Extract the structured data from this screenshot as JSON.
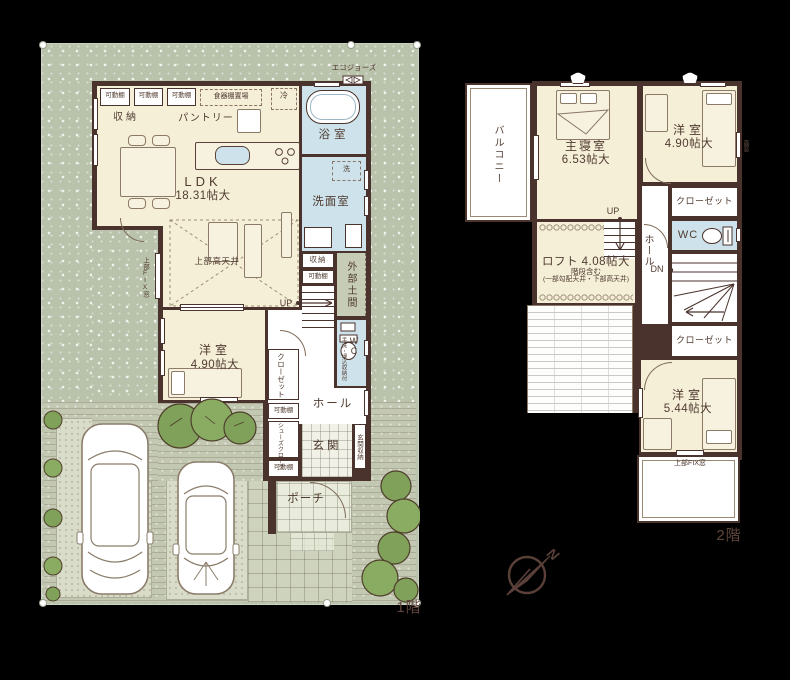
{
  "f1": {
    "tag": "1階",
    "ldk_name": "LDK",
    "ldk_size": "18.31帖大",
    "storage": "収納",
    "pantry": "パントリー",
    "shelf": "可動棚",
    "cupboard": "食器棚置場",
    "fridge": "冷",
    "eco": "エコジョーズ",
    "bath": "浴室",
    "washer": "洗",
    "washroom": "洗面室",
    "high_ceiling": "上部高天井",
    "fix_window": "上部FIX窓",
    "doma": "外部土間",
    "up": "UP",
    "wc": "WC",
    "wc_note": "手洗・埋込収納付",
    "west_name": "洋室",
    "west_size": "4.90帖大",
    "closet": "クローゼット",
    "hall": "ホール",
    "shoes": "シューズクローク",
    "genkan": "玄関",
    "genkan_storage": "玄関収納",
    "porch": "ポーチ"
  },
  "f2": {
    "tag": "2階",
    "balcony": "バルコニー",
    "master_name": "主寝室",
    "master_size": "6.53帖大",
    "westA_name": "洋室",
    "westA_size": "4.90帖大",
    "high_window": "高窓",
    "closetA": "クローゼット",
    "wc": "WC",
    "hall": "ホール",
    "up": "UP",
    "dn": "DN",
    "loft_name": "ロフト",
    "loft_size": "4.08帖大",
    "loft_note1": "階段含む",
    "loft_note2": "(一部勾配天井・下部高天井)",
    "closetB": "クローゼット",
    "westB_name": "洋室",
    "westB_size": "5.44帖大",
    "fix_window": "上部FIX窓"
  },
  "compass": {
    "north": "N"
  },
  "colors": {
    "wall": "#4a332c",
    "room_cream": "#f5efd8",
    "wet_blue": "#cde2ea",
    "yard_green": "#b9c2ab",
    "tree_green": "#7fa159",
    "text_brown": "#503b30"
  }
}
